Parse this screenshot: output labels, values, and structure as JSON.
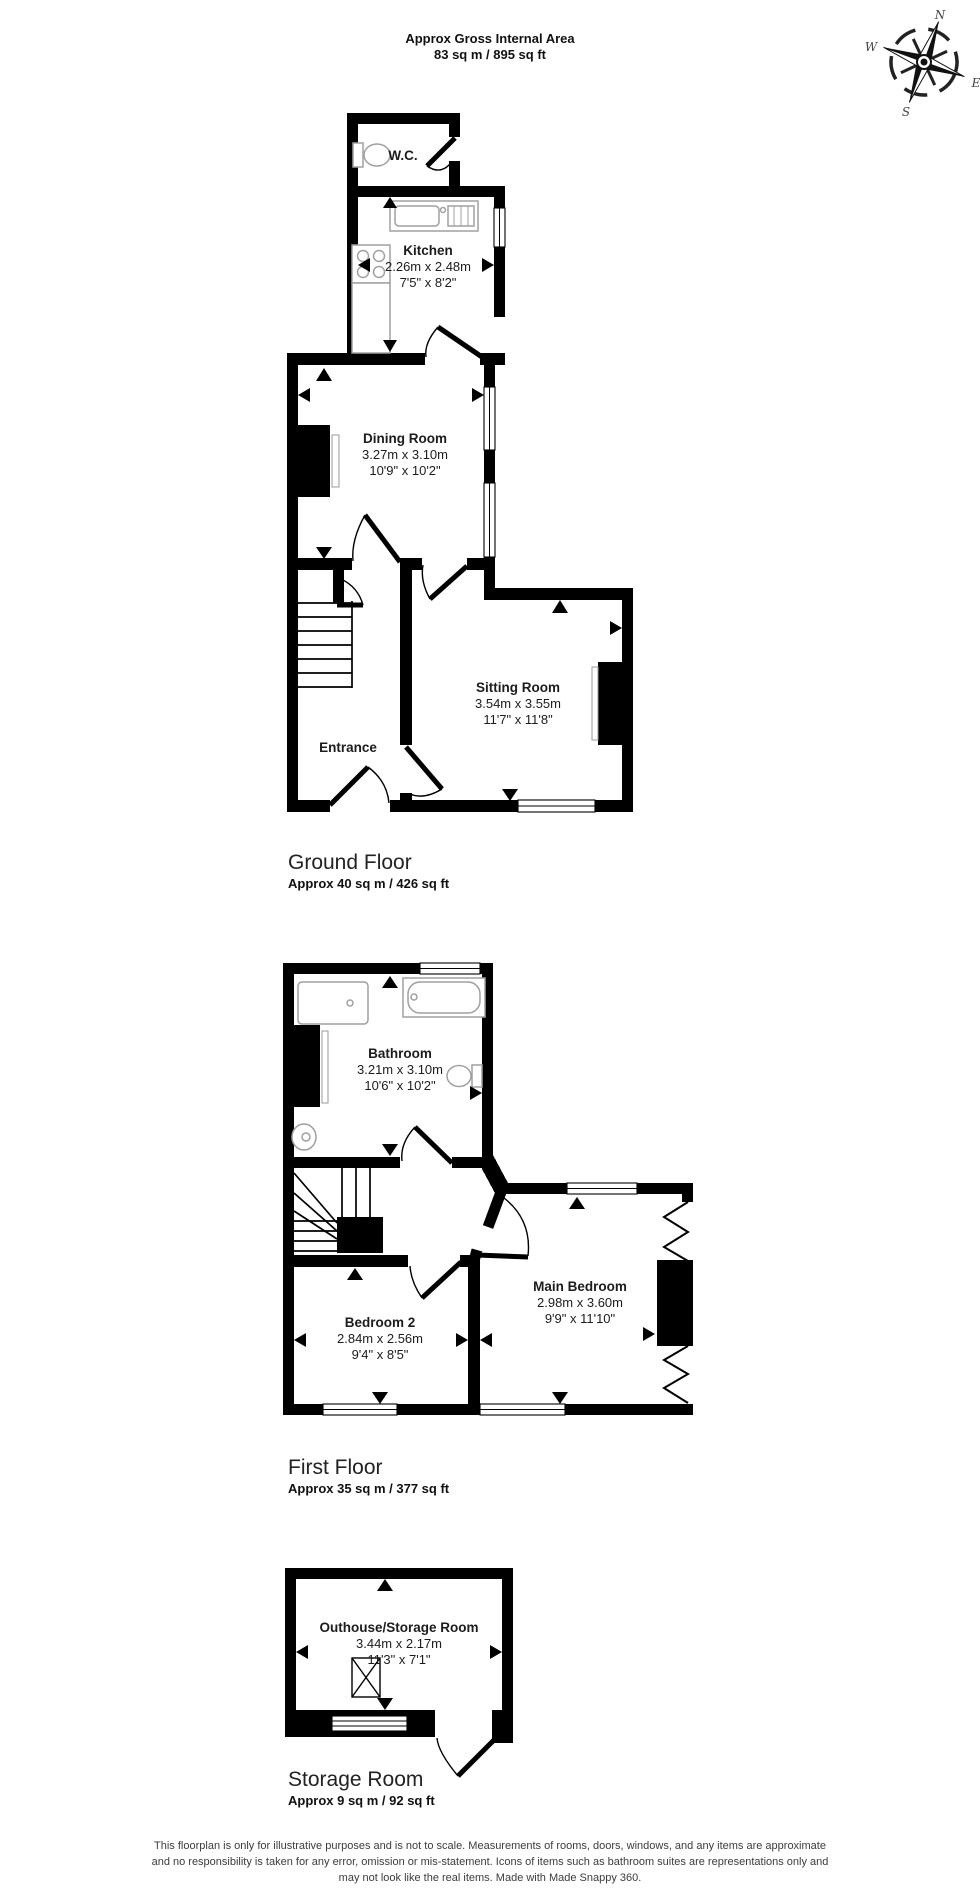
{
  "header": {
    "line1": "Approx Gross Internal Area",
    "line2": "83 sq m / 895 sq ft"
  },
  "compass": {
    "n": "N",
    "e": "E",
    "s": "S",
    "w": "W"
  },
  "floors": {
    "ground": {
      "title": "Ground Floor",
      "area": "Approx 40 sq m / 426 sq ft",
      "rooms": {
        "wc": {
          "name": "W.C."
        },
        "kitchen": {
          "name": "Kitchen",
          "dims_m": "2.26m x 2.48m",
          "dims_ft": "7'5\" x 8'2\""
        },
        "dining": {
          "name": "Dining Room",
          "dims_m": "3.27m x 3.10m",
          "dims_ft": "10'9\" x 10'2\""
        },
        "sitting": {
          "name": "Sitting Room",
          "dims_m": "3.54m x 3.55m",
          "dims_ft": "11'7\" x 11'8\""
        },
        "entrance": {
          "name": "Entrance"
        }
      }
    },
    "first": {
      "title": "First Floor",
      "area": "Approx 35 sq m / 377 sq ft",
      "rooms": {
        "bathroom": {
          "name": "Bathroom",
          "dims_m": "3.21m x 3.10m",
          "dims_ft": "10'6\" x 10'2\""
        },
        "bedroom2": {
          "name": "Bedroom 2",
          "dims_m": "2.84m x 2.56m",
          "dims_ft": "9'4\" x 8'5\""
        },
        "main_bedroom": {
          "name": "Main Bedroom",
          "dims_m": "2.98m x 3.60m",
          "dims_ft": "9'9\" x 11'10\""
        }
      }
    },
    "storage": {
      "title": "Storage Room",
      "area": "Approx 9 sq m / 92 sq ft",
      "rooms": {
        "outhouse": {
          "name": "Outhouse/Storage Room",
          "dims_m": "3.44m x 2.17m",
          "dims_ft": "11'3\" x 7'1\""
        }
      }
    }
  },
  "footer": {
    "line1": "This floorplan is only for illustrative purposes and is not to scale. Measurements of rooms, doors, windows, and any items are approximate",
    "line2": "and no responsibility is taken for any error, omission or mis-statement. Icons of items such as bathroom suites are representations only and",
    "line3": "may not look like the real items. Made with Made Snappy 360."
  },
  "colors": {
    "wall": "#000000",
    "fixture_outline": "#a0a0a0",
    "text": "#1c1c1c",
    "background": "#ffffff"
  }
}
